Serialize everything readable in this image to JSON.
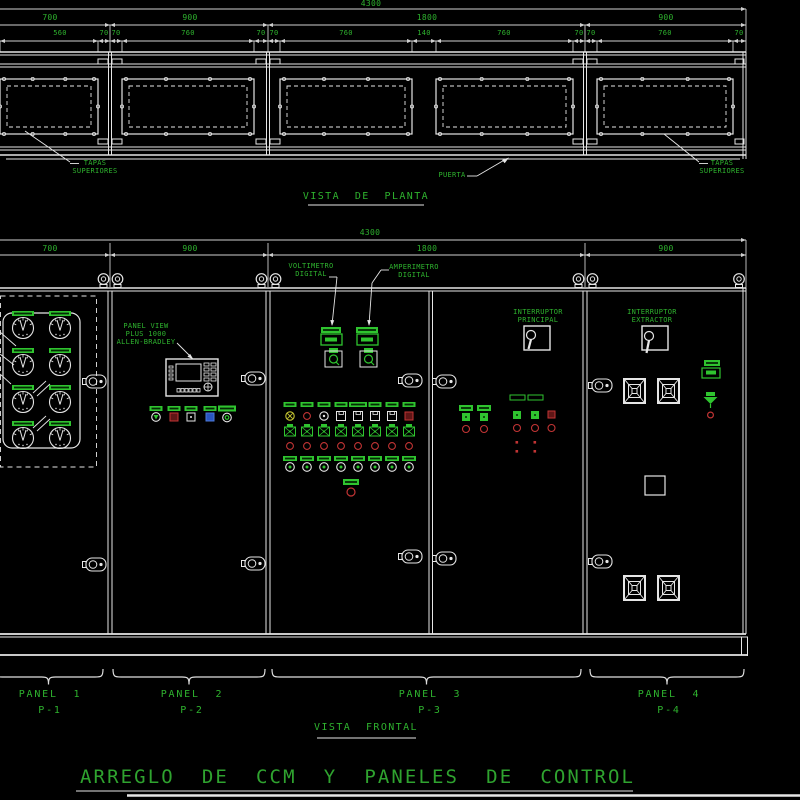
{
  "drawing": {
    "title": "ARREGLO  DE  CCM  Y  PANELES  DE  CONTROL",
    "plan": {
      "caption": "VISTA  DE  PLANTA",
      "dim_total": "4300",
      "dim_panels": [
        "700",
        "900",
        "1800",
        "900"
      ],
      "dim_openings": [
        "560",
        "70",
        "70",
        "760",
        "70",
        "70",
        "760",
        "140",
        "760",
        "70",
        "70",
        "760",
        "70"
      ],
      "label_tapas_left": [
        "TAPAS",
        "SUPERIORES"
      ],
      "label_tapas_right": [
        "TAPAS",
        "SUPERIORES"
      ],
      "label_puerta": "PUERTA"
    },
    "front": {
      "caption": "VISTA  FRONTAL",
      "dim_total": "4300",
      "dim_panels": [
        "700",
        "900",
        "1800",
        "900"
      ],
      "label_voltimetro": [
        "VOLTIMETRO",
        "DIGITAL"
      ],
      "label_amperimetro": [
        "AMPERIMETRO",
        "DIGITAL"
      ],
      "label_panelview": [
        "PANEL VIEW",
        "PLUS 1000",
        "ALLEN-BRADLEY"
      ],
      "label_int_principal": [
        "INTERRUPTOR",
        "PRINCIPAL"
      ],
      "label_int_extractor": [
        "INTERRUPTOR",
        "EXTRACTOR"
      ],
      "panels": [
        {
          "name": "PANEL  1",
          "code": "P-1"
        },
        {
          "name": "PANEL  2",
          "code": "P-2"
        },
        {
          "name": "PANEL  3",
          "code": "P-3"
        },
        {
          "name": "PANEL  4",
          "code": "P-4"
        }
      ]
    },
    "colors": {
      "background": "#000000",
      "line": "#e6e6e6",
      "dim_line": "#cfcfcf",
      "text_green": "#2eb22e",
      "symbol_green": "#2fc42f",
      "indicator_red": "#c23434",
      "indicator_dark_red": "#5f1616",
      "indicator_yellow": "#c8c832",
      "indicator_blue": "#2a55c0"
    }
  }
}
